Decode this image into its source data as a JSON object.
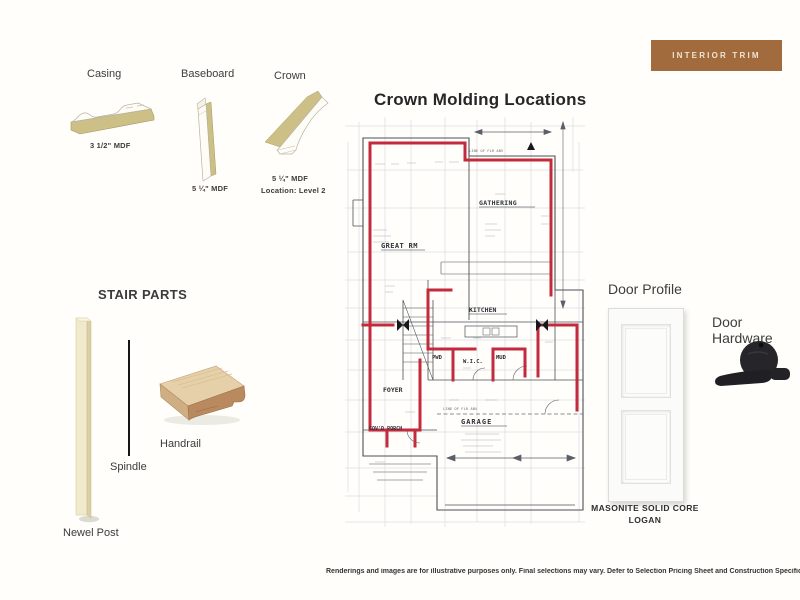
{
  "colors": {
    "banner_bg": "#a16b3e",
    "crown_highlight": "#c32b3c",
    "trim_tan": "#cdc086"
  },
  "banner": {
    "label": "INTERIOR TRIM"
  },
  "trim_profiles": {
    "casing": {
      "title": "Casing",
      "spec": "3 1/2\" MDF"
    },
    "baseboard": {
      "title": "Baseboard",
      "spec": "5 ¼\" MDF"
    },
    "crown": {
      "title": "Crown",
      "spec": "5 ¼\" MDF",
      "location": "Location: Level 2"
    }
  },
  "floor_plan": {
    "title": "Crown Molding Locations",
    "rooms": [
      {
        "label": "GREAT RM"
      },
      {
        "label": "GATHERING"
      },
      {
        "label": "KITCHEN"
      },
      {
        "label": "PWD"
      },
      {
        "label": "W.I.C."
      },
      {
        "label": "MUD"
      },
      {
        "label": "FOYER"
      },
      {
        "label": "COV'D PORCH"
      },
      {
        "label": "GARAGE"
      }
    ],
    "annotations": [
      {
        "label": "LINE OF FLR ABV"
      }
    ]
  },
  "stair_parts": {
    "title": "STAIR PARTS",
    "newel_label": "Newel Post",
    "spindle_label": "Spindle",
    "handrail_label": "Handrail"
  },
  "door_profile": {
    "title": "Door Profile",
    "brand": "MASONITE SOLID CORE",
    "model": "LOGAN"
  },
  "door_hardware": {
    "title": "Door Hardware"
  },
  "footer": {
    "disclaimer": "Renderings and images are for illustrative purposes only. Final selections may vary. Defer to Selection Pricing Sheet and Construction Specifications for final sel"
  }
}
